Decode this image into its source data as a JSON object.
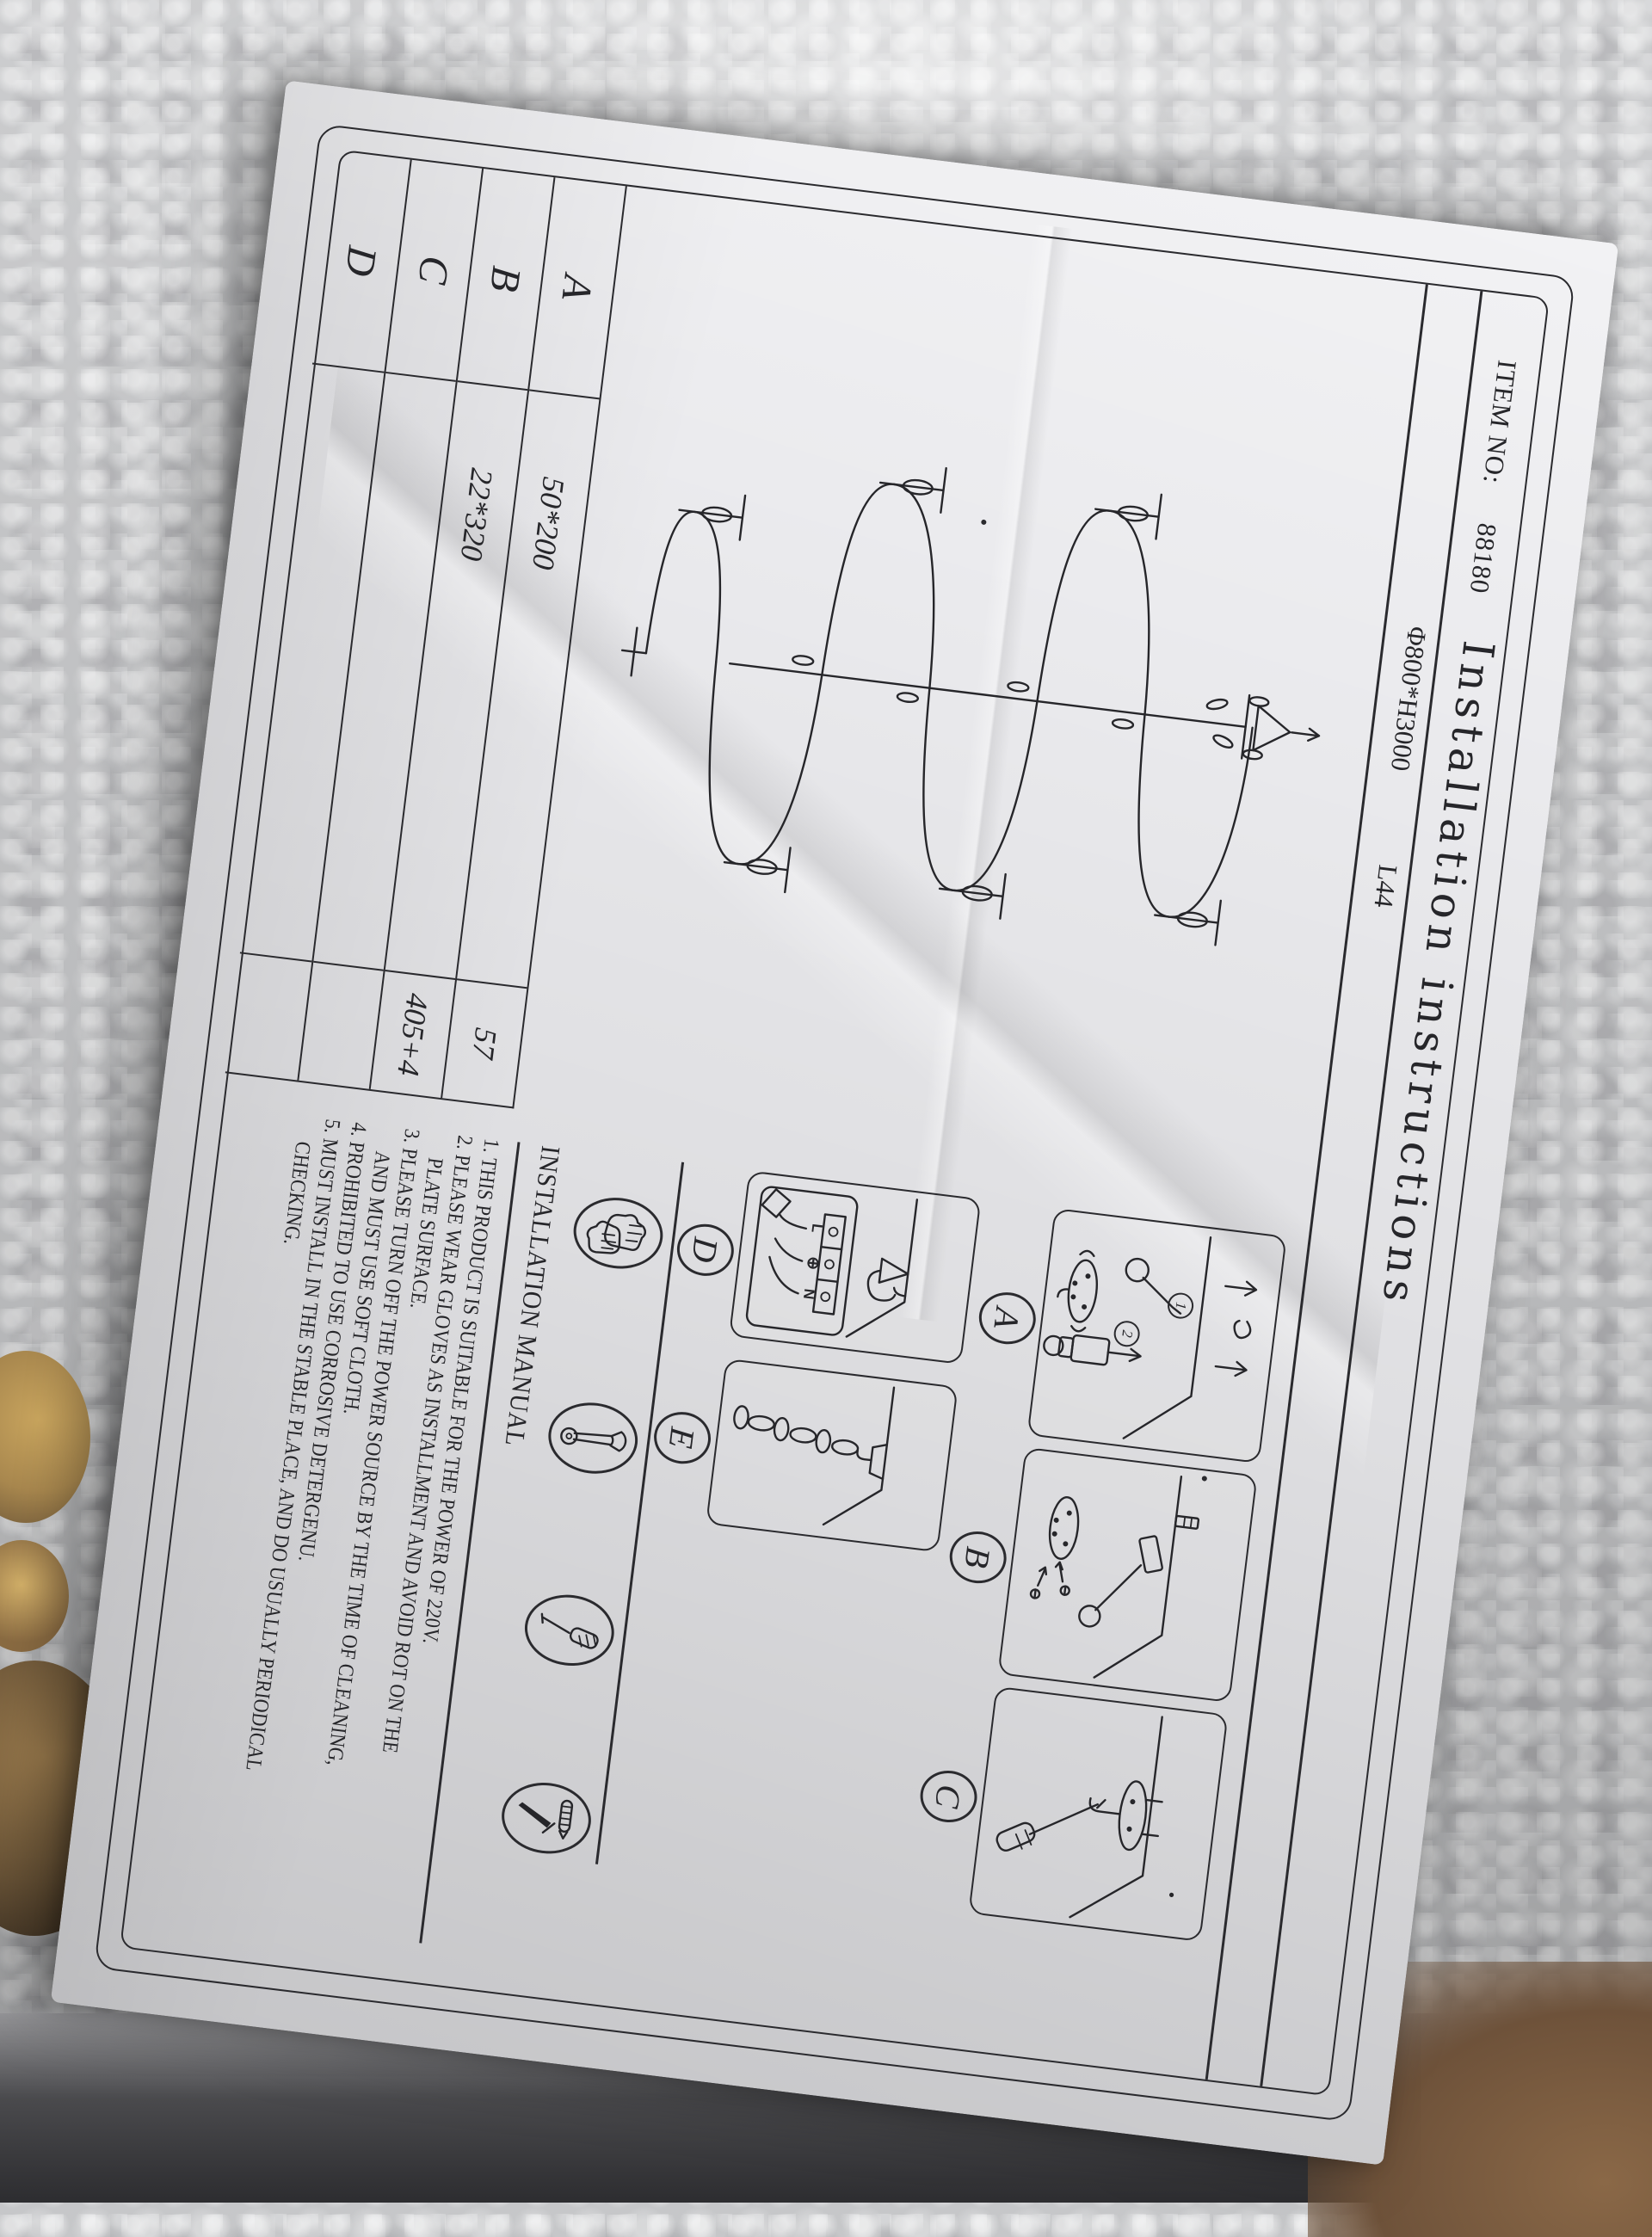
{
  "photo": {
    "background_color": "#c6c7c9",
    "paper_color": "#ebebee",
    "ink_color": "#26262a",
    "packing_gold_color": "#a8874e"
  },
  "header": {
    "item_no_label": "ITEM NO:",
    "item_no_value": "88180",
    "spec_value": "Φ800*H3000",
    "lamp_count": "L44",
    "title": "Installation instructions"
  },
  "parts_table": {
    "rows": [
      {
        "key": "A",
        "size": "50*200",
        "qty": "57"
      },
      {
        "key": "B",
        "size": "22*320",
        "qty": "405+4"
      },
      {
        "key": "C",
        "size": "",
        "qty": ""
      },
      {
        "key": "D",
        "size": "",
        "qty": ""
      }
    ]
  },
  "diagram_panels": {
    "labels": [
      "A",
      "B",
      "C",
      "D",
      "E"
    ],
    "step_numbers": [
      "1",
      "2"
    ],
    "wiring_terminals": {
      "live": "L",
      "earth": "⊕",
      "neutral": "N"
    }
  },
  "tool_icons": [
    "gloves-icon",
    "wrench-icon",
    "screwdriver-icon",
    "anchor-awl-icon"
  ],
  "manual": {
    "heading": "INSTALLATION MANUAL",
    "items": [
      "1. THIS PRODUCT IS SUITABLE FOR THE POWER OF 220V.",
      "2. PLEASE WEAR GLOVES AS INSTALLMENT AND AVOID ROT ON THE PLATE SURFACE.",
      "3. PLEASE TURN OFF THE POWER SOURCE BY THE TIME OF CLEANING, AND MUST USE SOFT CLOTH.",
      "4. PROHIBITED TO USE CORROSIVE DETERGENU.",
      "5. MUST INSTALL IN THE STABLE PLACE, AND DO USUALLY PERIODICAL CHECKING."
    ]
  }
}
